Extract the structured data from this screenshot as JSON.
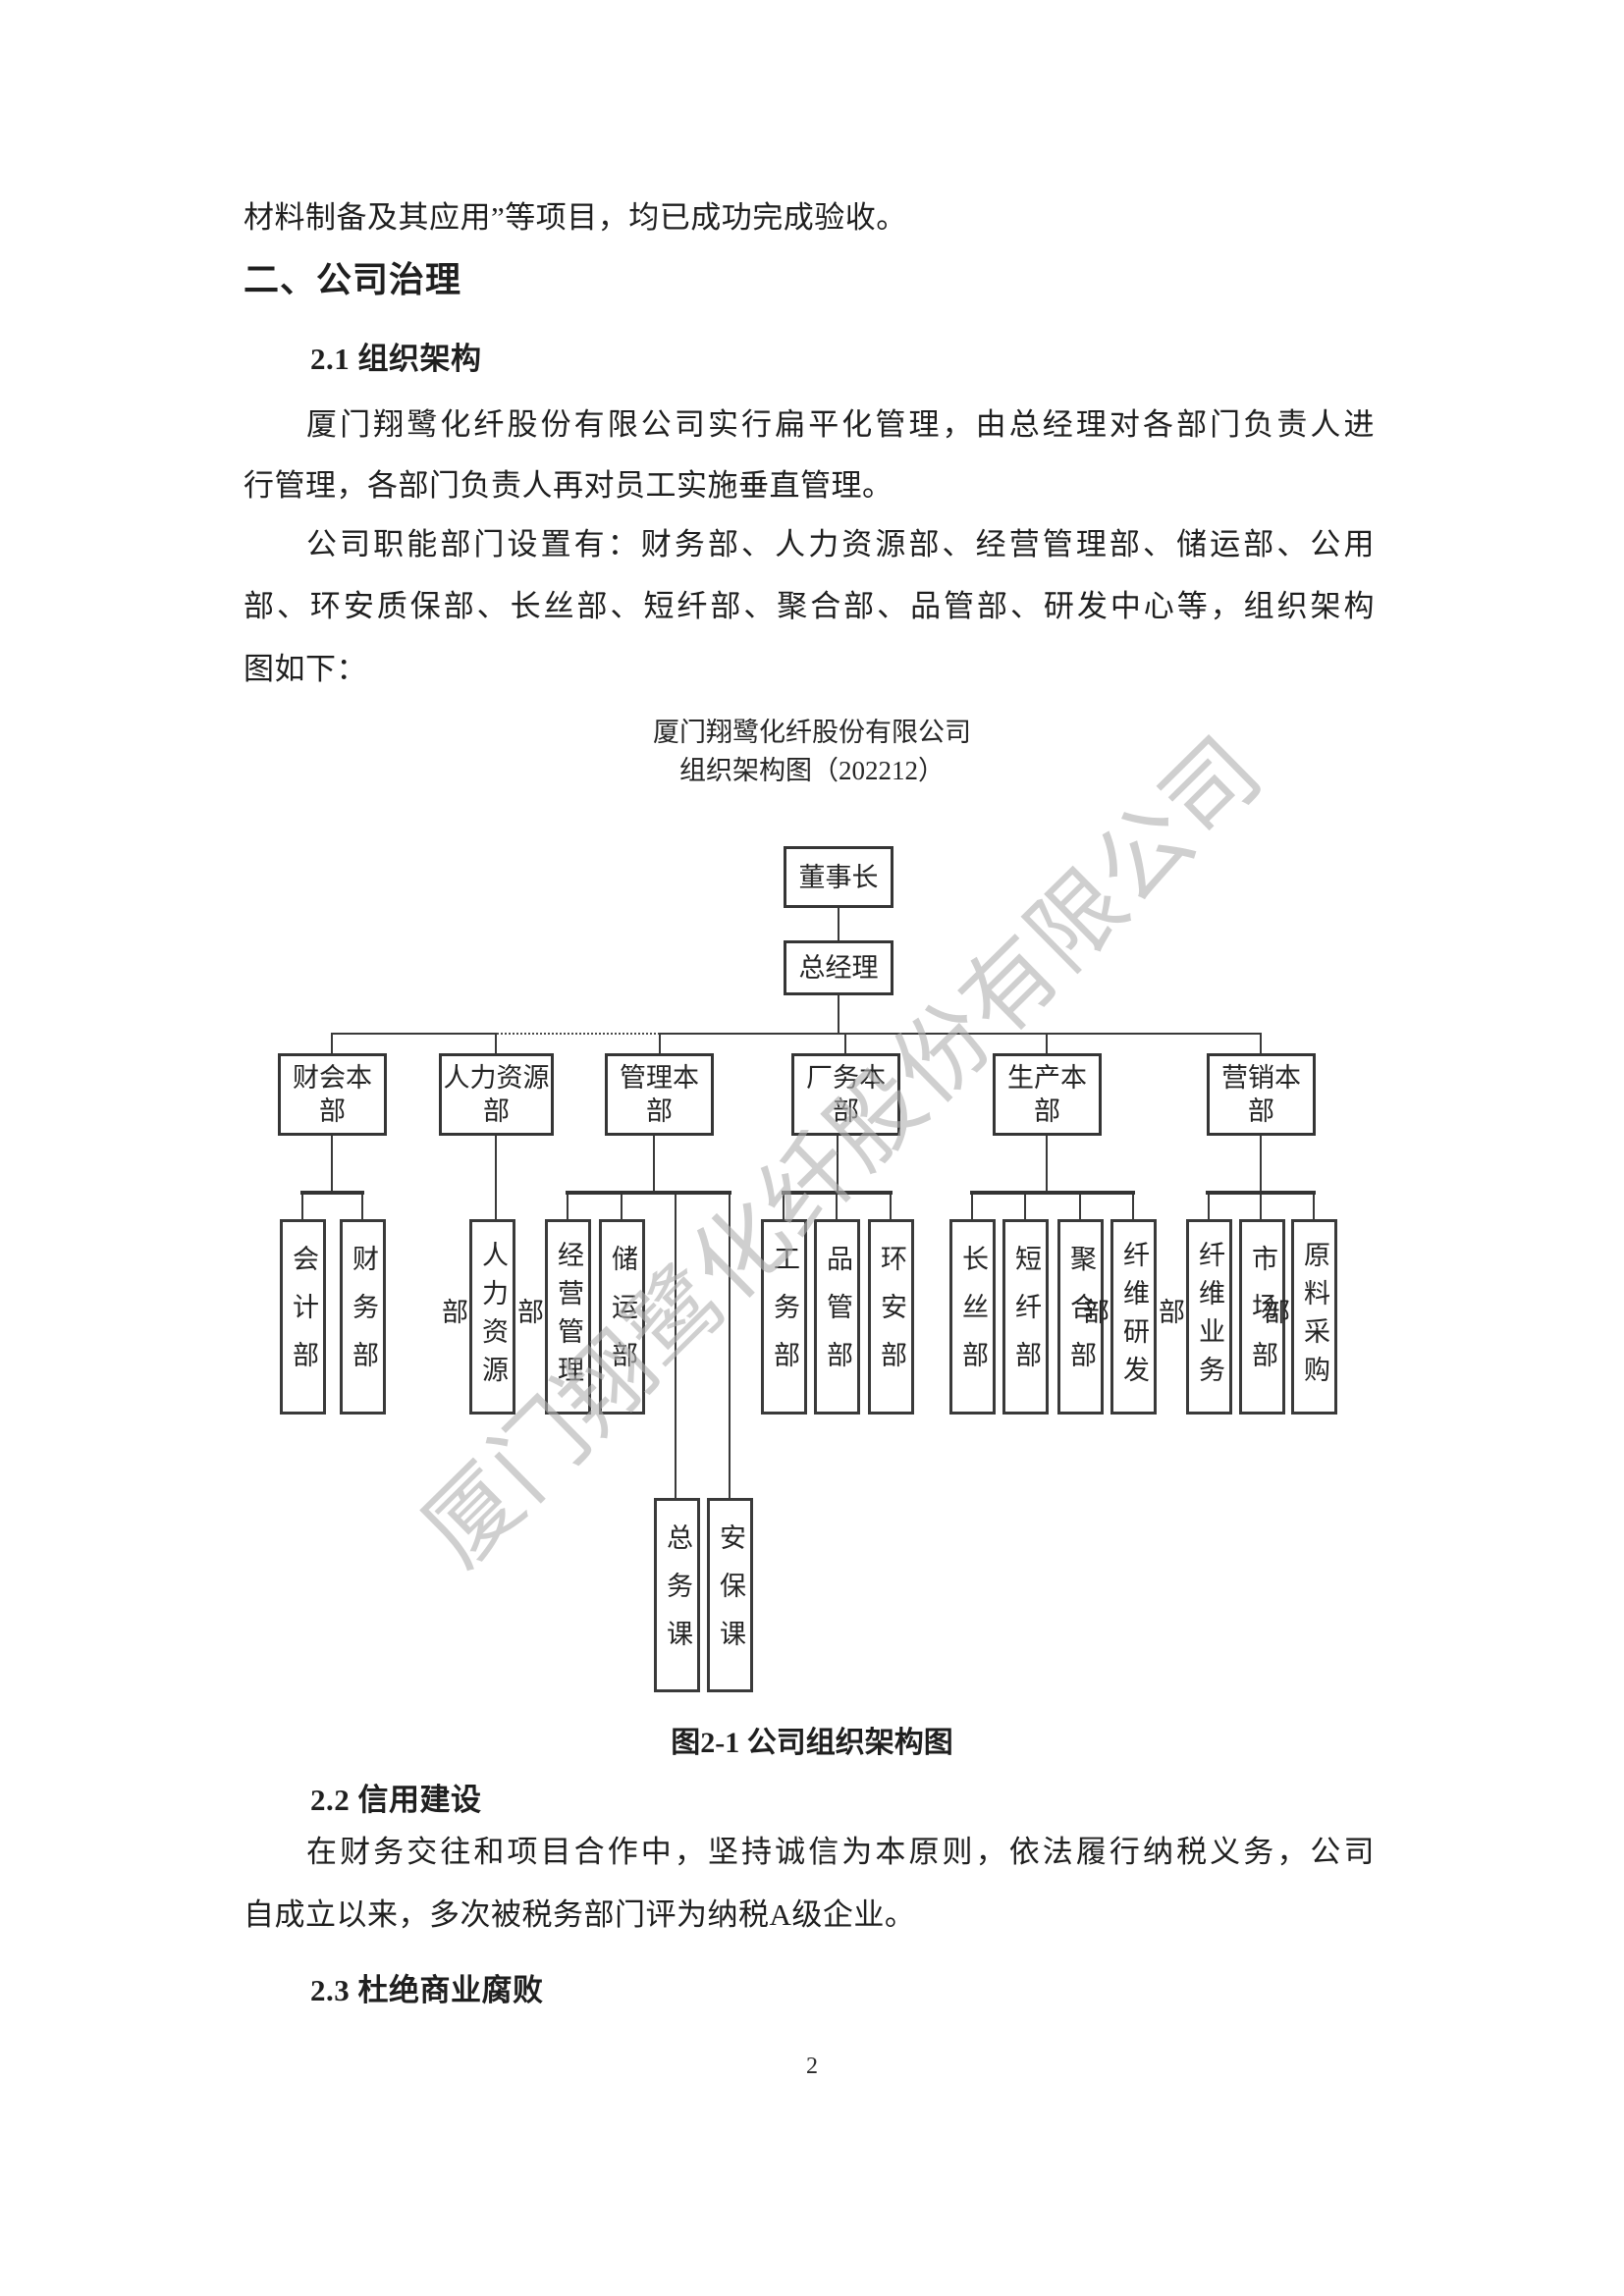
{
  "page": {
    "number": "2",
    "watermark": "厦门翔鹭化纤股份有限公司"
  },
  "body": {
    "leading_line": "材料制备及其应用”等项目，均已成功完成验收。",
    "h2": "二、公司治理",
    "s21": {
      "heading": "2.1 组织架构",
      "p1_line1": "厦门翔鹭化纤股份有限公司实行扁平化管理，由总经理对各部门负责人进",
      "p1_line2": "行管理，各部门负责人再对员工实施垂直管理。",
      "p2_line1": "公司职能部门设置有：财务部、人力资源部、经营管理部、储运部、公用",
      "p2_line2": "部、环安质保部、长丝部、短纤部、聚合部、品管部、研发中心等，组织架构",
      "p2_line3": "图如下："
    },
    "s22": {
      "heading": "2.2 信用建设",
      "p1_line1": "在财务交往和项目合作中，坚持诚信为本原则，依法履行纳税义务，公司",
      "p1_line2": "自成立以来，多次被税务部门评为纳税A级企业。"
    },
    "s23": {
      "heading": "2.3 杜绝商业腐败"
    }
  },
  "org_chart": {
    "title1": "厦门翔鹭化纤股份有限公司",
    "title2": "组织架构图（202212）",
    "caption": "图2-1 公司组织架构图",
    "chairman": "董事长",
    "general_manager": "总经理",
    "divisions": [
      {
        "label": "财会本部",
        "children": [
          "会计部",
          "财务部"
        ]
      },
      {
        "label": "人力资源部",
        "children": [
          "人力资源部"
        ]
      },
      {
        "label": "管理本部",
        "children": [
          "经营管理部",
          "储运部"
        ],
        "subsections": [
          "总务课",
          "安保课"
        ]
      },
      {
        "label": "厂务本部",
        "children": [
          "工务部",
          "品管部",
          "环安部"
        ]
      },
      {
        "label": "生产本部",
        "children": [
          "长丝部",
          "短纤部",
          "聚合部",
          "纤维研发部"
        ]
      },
      {
        "label": "营销本部",
        "children": [
          "纤维业务部",
          "市场部",
          "原料采购部"
        ]
      }
    ]
  }
}
